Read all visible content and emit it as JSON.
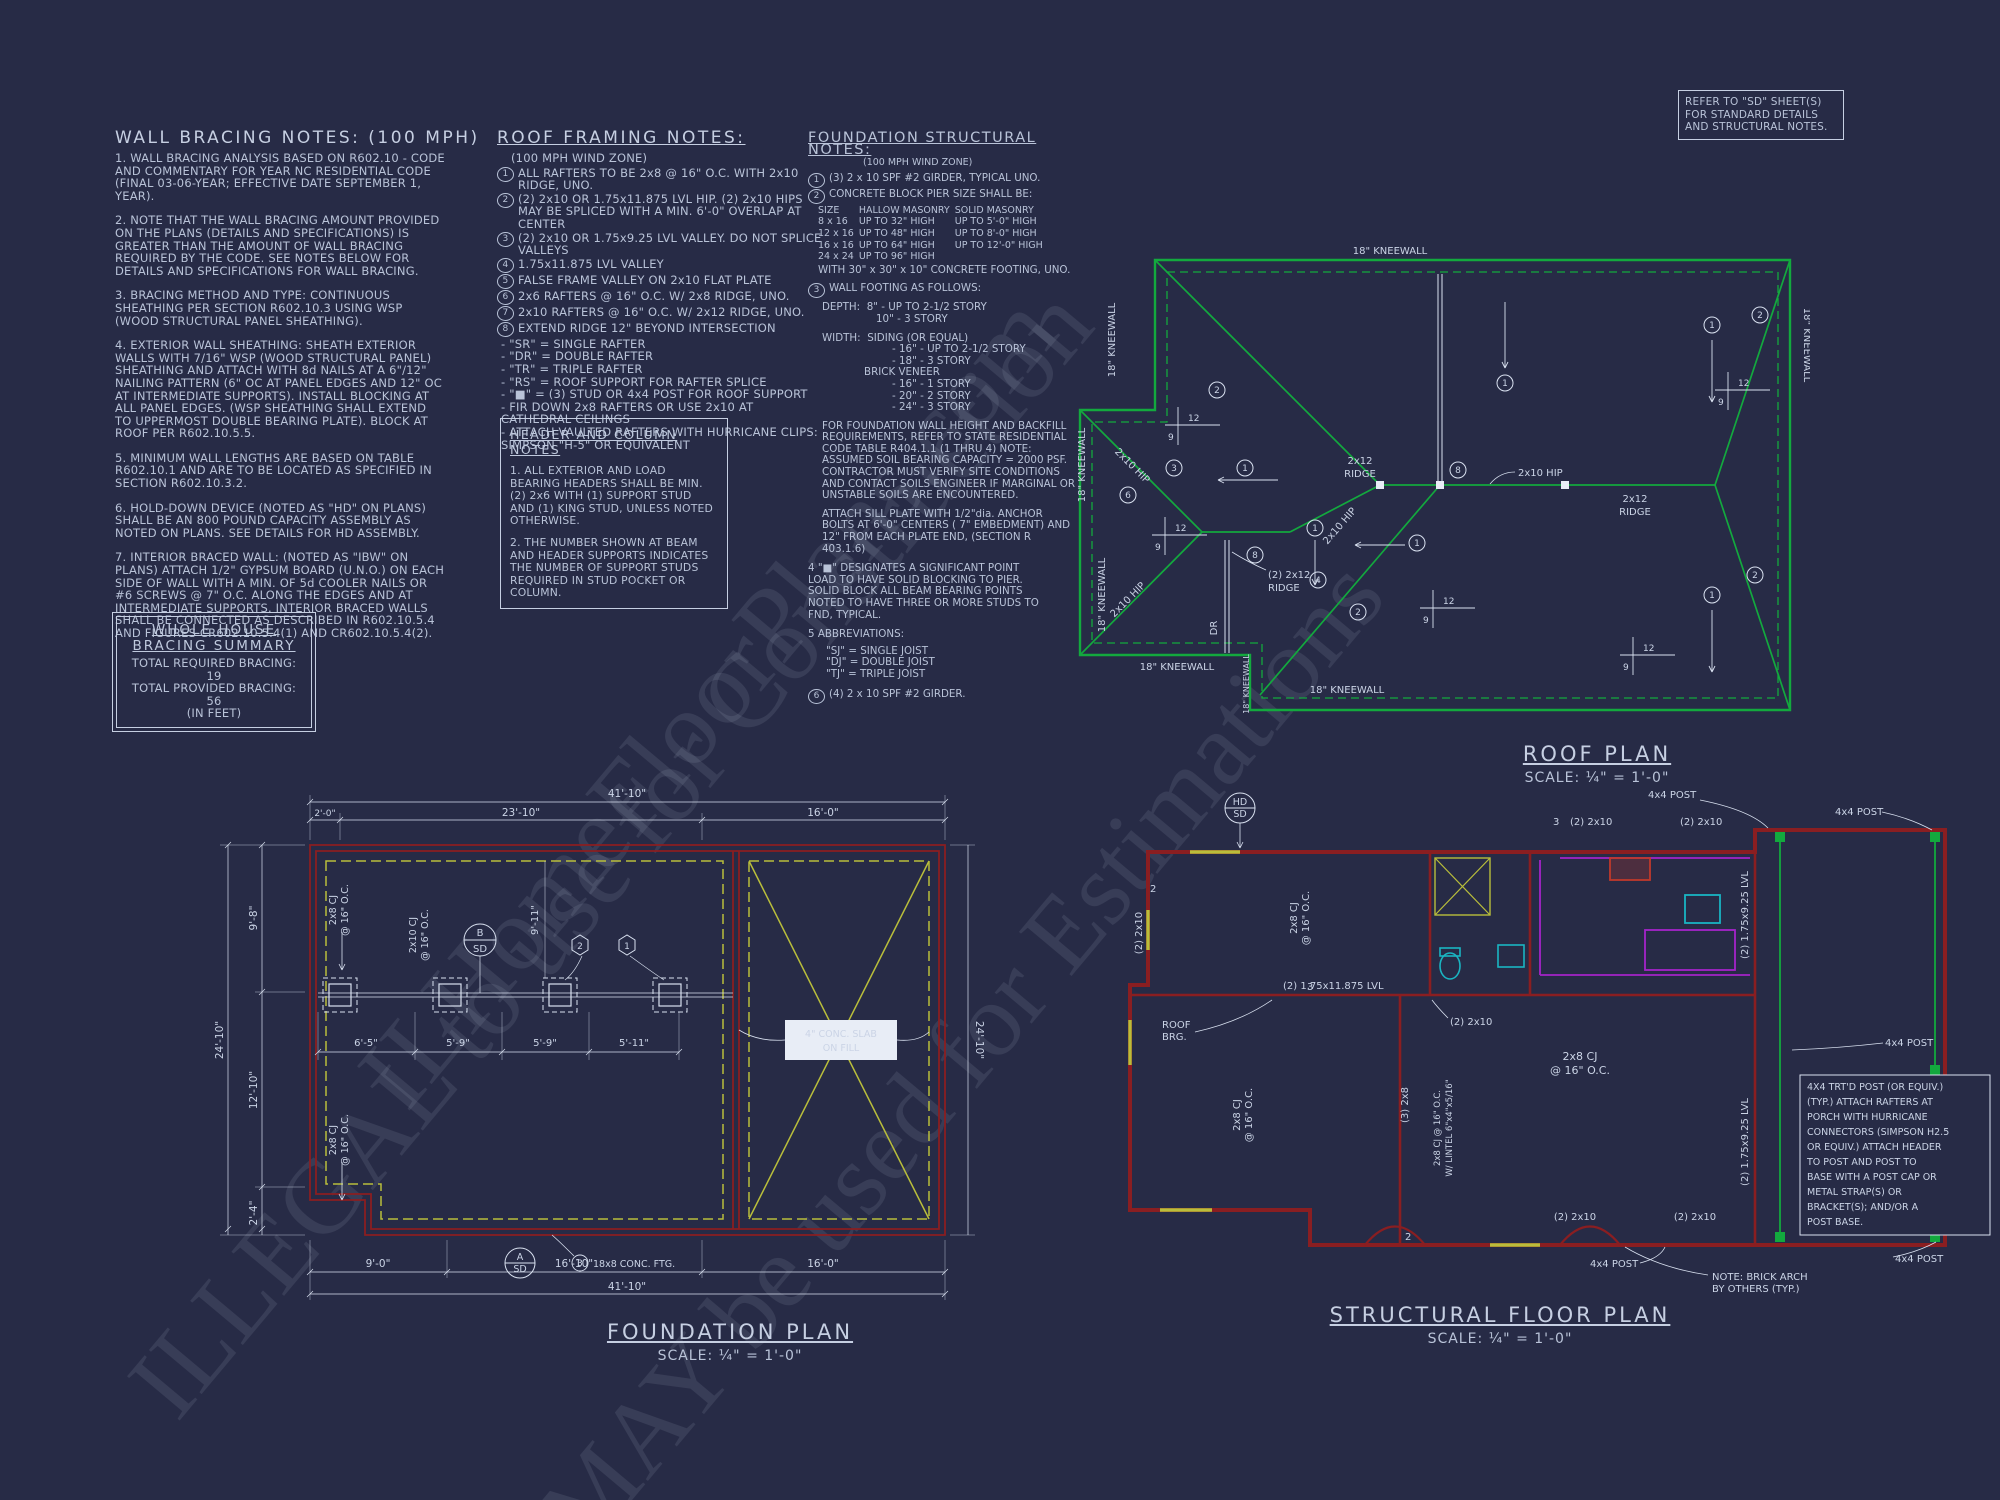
{
  "watermark": {
    "line1": "ILHomeFloorPlans.com",
    "line2": "ILLEGAL to use for Construction",
    "line3": "MAY be used for Estimations"
  },
  "colors": {
    "background": "#272b46",
    "green": "#13a93e",
    "red": "#8a1e21",
    "yellow": "#b9be3b",
    "purple": "#a524c9",
    "cyan": "#1ab5c2",
    "white_line": "#d9e1f0"
  },
  "wall_bracing": {
    "title": "WALL BRACING NOTES: (100 MPH)",
    "notes": [
      "1. WALL BRACING ANALYSIS BASED ON R602.10 - CODE AND COMMENTARY FOR YEAR NC RESIDENTIAL CODE (FINAL 03-06-YEAR; EFFECTIVE DATE SEPTEMBER 1, YEAR).",
      "2. NOTE THAT THE WALL BRACING AMOUNT PROVIDED ON THE PLANS (DETAILS AND SPECIFICATIONS) IS GREATER THAN THE AMOUNT OF WALL BRACING REQUIRED BY THE CODE. SEE NOTES BELOW FOR DETAILS AND SPECIFICATIONS FOR WALL BRACING.",
      "3. BRACING METHOD AND TYPE: CONTINUOUS SHEATHING PER SECTION R602.10.3 USING WSP (WOOD STRUCTURAL PANEL SHEATHING).",
      "4. EXTERIOR WALL SHEATHING: SHEATH EXTERIOR WALLS WITH 7/16\" WSP (WOOD STRUCTURAL PANEL) SHEATHING AND ATTACH WITH 8d NAILS AT A 6\"/12\" NAILING PATTERN (6\" OC AT PANEL EDGES AND 12\" OC AT INTERMEDIATE SUPPORTS). INSTALL BLOCKING AT ALL PANEL EDGES. (WSP SHEATHING SHALL EXTEND TO UPPERMOST DOUBLE BEARING PLATE). BLOCK AT ROOF PER R602.10.5.5.",
      "5. MINIMUM WALL LENGTHS ARE BASED ON TABLE R602.10.1 AND ARE TO BE LOCATED AS SPECIFIED IN SECTION R602.10.3.2.",
      "6. HOLD-DOWN DEVICE (NOTED AS \"HD\" ON PLANS) SHALL BE AN 800 POUND CAPACITY ASSEMBLY AS NOTED ON PLANS. SEE DETAILS FOR HD ASSEMBLY.",
      "7. INTERIOR BRACED WALL: (NOTED AS \"IBW\" ON PLANS) ATTACH 1/2\" GYPSUM BOARD (U.N.O.) ON EACH SIDE OF WALL WITH A MIN. OF 5d COOLER NAILS OR #6 SCREWS @ 7\" O.C. ALONG THE EDGES AND AT INTERMEDIATE SUPPORTS.  INTERIOR BRACED WALLS SHALL BE CONNECTED AS DESCRIBED IN R602.10.5.4 AND FIGURES CR602.10.5.4(1) AND CR602.10.5.4(2)."
    ]
  },
  "bracing_summary": {
    "heading1": "WHOLE HOUSE",
    "heading2": "BRACING SUMMARY",
    "required": "TOTAL REQUIRED BRACING: 19",
    "provided": "TOTAL PROVIDED BRACING: 56",
    "units": "(IN FEET)"
  },
  "roof_notes": {
    "title": "ROOF FRAMING NOTES:",
    "subtitle": "(100 MPH WIND ZONE)",
    "items": [
      {
        "n": "1",
        "t": "ALL RAFTERS TO BE 2x8 @ 16\" O.C. WITH 2x10 RIDGE, UNO."
      },
      {
        "n": "2",
        "t": "(2) 2x10 OR 1.75x11.875 LVL HIP. (2) 2x10 HIPS MAY BE SPLICED WITH A MIN. 6'-0\" OVERLAP AT CENTER"
      },
      {
        "n": "3",
        "t": "(2) 2x10 OR 1.75x9.25 LVL VALLEY. DO NOT SPLICE VALLEYS"
      },
      {
        "n": "4",
        "t": "1.75x11.875 LVL VALLEY"
      },
      {
        "n": "5",
        "t": "FALSE FRAME VALLEY ON 2x10 FLAT PLATE"
      },
      {
        "n": "6",
        "t": "2x6 RAFTERS @ 16\" O.C. W/ 2x8 RIDGE, UNO."
      },
      {
        "n": "7",
        "t": "2x10 RAFTERS @ 16\" O.C. W/ 2x12 RIDGE, UNO."
      },
      {
        "n": "8",
        "t": "EXTEND RIDGE 12\" BEYOND INTERSECTION"
      }
    ],
    "bullets": [
      "\"SR\" = SINGLE RAFTER",
      "\"DR\" = DOUBLE RAFTER",
      "\"TR\" = TRIPLE RAFTER",
      "\"RS\" = ROOF SUPPORT FOR RAFTER SPLICE",
      "\"■\"  = (3) STUD OR 4x4 POST FOR ROOF SUPPORT",
      "FIR DOWN 2x8 RAFTERS OR USE 2x10 AT CATHEDRAL CEILINGS",
      "ATTACH VAULTED RAFTERS WITH HURRICANE CLIPS: SIMPSON \"H-5\" OR EQUIVALENT"
    ]
  },
  "header_notes": {
    "title": "HEADER AND COLUMN NOTES",
    "p1": "1. ALL EXTERIOR AND LOAD BEARING HEADERS SHALL BE MIN. (2) 2x6 WITH (1) SUPPORT STUD AND (1) KING STUD, UNLESS NOTED OTHERWISE.",
    "p2": "2. THE NUMBER SHOWN AT BEAM AND HEADER SUPPORTS INDICATES THE NUMBER OF SUPPORT STUDS REQUIRED IN STUD POCKET OR COLUMN."
  },
  "foundation_notes": {
    "title": "FOUNDATION STRUCTURAL NOTES:",
    "subtitle": "(100 MPH WIND ZONE)",
    "n1": "(3) 2 x 10 SPF #2 GIRDER, TYPICAL UNO.",
    "n2_intro": "CONCRETE BLOCK PIER SIZE SHALL BE:",
    "pier_table": {
      "header": [
        "SIZE",
        "HALLOW MASONRY",
        "SOLID MASONRY"
      ],
      "rows": [
        [
          "8 x 16",
          "UP TO 32\" HIGH",
          "UP TO 5'-0\" HIGH"
        ],
        [
          "12 x 16",
          "UP TO 48\" HIGH",
          "UP TO 8'-0\" HIGH"
        ],
        [
          "16 x 16",
          "UP TO 64\" HIGH",
          "UP TO 12'-0\" HIGH"
        ],
        [
          "24 x 24",
          "UP TO 96\" HIGH",
          ""
        ]
      ],
      "footer": "WITH 30\" x 30\" x 10\" CONCRETE FOOTING, UNO."
    },
    "n3_intro": "WALL FOOTING AS FOLLOWS:",
    "depth_label": "DEPTH:",
    "depth1": "8\" - UP TO 2-1/2 STORY",
    "depth2": "10\" - 3 STORY",
    "width_label": "WIDTH:",
    "width1": "SIDING (OR EQUAL)",
    "width2": "- 16\" - UP TO 2-1/2 STORY",
    "width3": "- 18\" - 3 STORY",
    "width4": "BRICK VENEER",
    "width5": "- 16\" - 1 STORY",
    "width6": "- 20\" - 2 STORY",
    "width7": "- 24\" - 3 STORY",
    "n3_para1": "FOR FOUNDATION WALL HEIGHT AND BACKFILL REQUIREMENTS, REFER TO STATE RESIDENTIAL CODE TABLE R404.1.1 (1 THRU 4) NOTE: ASSUMED SOIL BEARING CAPACITY = 2000 PSF. CONTRACTOR MUST VERIFY SITE CONDITIONS AND CONTACT SOILS ENGINEER IF MARGINAL OR UNSTABLE SOILS ARE ENCOUNTERED.",
    "n3_para2": "ATTACH SILL PLATE WITH 1/2\"dia. ANCHOR BOLTS AT 6'-0\" CENTERS ( 7\" EMBEDMENT) AND 12\" FROM EACH PLATE END, (SECTION R 403.1.6)",
    "n4": "4  \"■\" DESIGNATES A SIGNIFICANT POINT LOAD TO HAVE SOLID BLOCKING TO PIER. SOLID BLOCK ALL BEAM BEARING POINTS NOTED TO HAVE THREE OR MORE STUDS TO FND, TYPICAL.",
    "n5": "5  ABBREVIATIONS:",
    "abbr1": "\"SJ\" = SINGLE JOIST",
    "abbr2": "\"DJ\" = DOUBLE JOIST",
    "abbr3": "\"TJ\" = TRIPLE JOIST",
    "n6": "(4) 2 x 10 SPF #2 GIRDER."
  },
  "sd_box": {
    "l1": "REFER TO \"SD\" SHEET(S)",
    "l2": "FOR STANDARD DETAILS",
    "l3": "AND STRUCTURAL NOTES."
  },
  "roof_plan": {
    "title": "ROOF PLAN",
    "scale": "SCALE: ¼\" = 1'-0\"",
    "kneewall": "18\" KNEEWALL",
    "hip": "2x10 HIP",
    "ridge_a": "2x12",
    "ridge_b": "RIDGE",
    "ridge2_a": "(2) 2x12",
    "ridge2_b": "RIDGE",
    "dr": "DR",
    "rise": "12",
    "run": "9",
    "c1": "1",
    "c2": "2",
    "c3": "3",
    "c4": "4",
    "c6": "6",
    "c8": "8"
  },
  "foundation_plan": {
    "title": "FOUNDATION PLAN",
    "scale": "SCALE: ¼\" = 1'-0\"",
    "dims": {
      "top_overall": "41'-10\"",
      "top_s1": "2'-0\"",
      "top_s2": "23'-10\"",
      "top_s3": "16'-0\"",
      "left_overall": "24'-10\"",
      "left_s1": "9'-8\"",
      "left_s2": "12'-10\"",
      "left_s3": "2'-4\"",
      "right_overall": "24'-10\"",
      "bottom_s1": "9'-0\"",
      "bottom_s2": "16'-10\"",
      "bottom_s3": "16'-0\"",
      "bottom_overall": "41'-10\"",
      "g1": "6'-5\"",
      "g2": "5'-9\"",
      "g3": "5'-9\"",
      "g4": "5'-11\"",
      "mid_v": "9'-11\""
    },
    "labels": {
      "cj8a": "2x8 CJ",
      "cj8b": "@ 16\" O.C.",
      "cj10a": "2x10 CJ",
      "cj10b": "@ 16\" O.C.",
      "slab1": "4\" CONC. SLAB",
      "slab2": "ON FILL",
      "ftg": "18x8 CONC. FTG.",
      "bubA": "A",
      "bubB": "B",
      "bubSD": "SD",
      "hex1": "1",
      "hex2": "2",
      "c3": "3"
    }
  },
  "floor_plan": {
    "title": "STRUCTURAL FLOOR PLAN",
    "scale": "SCALE: ¼\" = 1'-0\"",
    "labels": {
      "hd": "HD",
      "sd": "SD",
      "l2x10": "(2) 2x10",
      "post": "4x4 POST",
      "lvl_h": "(2) 1.75x11.875 LVL",
      "lvl_v": "(2) 1.75x9.25 LVL",
      "cj_a": "2x8 CJ",
      "cj_b": "@ 16\" O.C.",
      "cj_full": "2x8 CJ @ 16\" O.C.",
      "lintel": "W/ LINTEL 6\"x4\"x5/16\"",
      "v2x10": "2x10",
      "l3_2x8": "(3) 2x8",
      "roof1": "ROOF",
      "roof2": "BRG.",
      "brick1": "NOTE: BRICK ARCH",
      "brick2": "BY OTHERS (TYP.)",
      "n2": "2",
      "n3": "3"
    },
    "post_note": {
      "l0": "4X4 TRT'D POST (OR EQUIV.)",
      "l1": "(TYP.) ATTACH RAFTERS AT",
      "l2": "PORCH WITH HURRICANE",
      "l3": "CONNECTORS (SIMPSON H2.5",
      "l4": "OR EQUIV.) ATTACH HEADER",
      "l5": "TO POST AND POST TO",
      "l6": "BASE WITH A POST CAP OR",
      "l7": "METAL STRAP(S) OR",
      "l8": "BRACKET(S); AND/OR A",
      "l9": "POST BASE."
    }
  }
}
